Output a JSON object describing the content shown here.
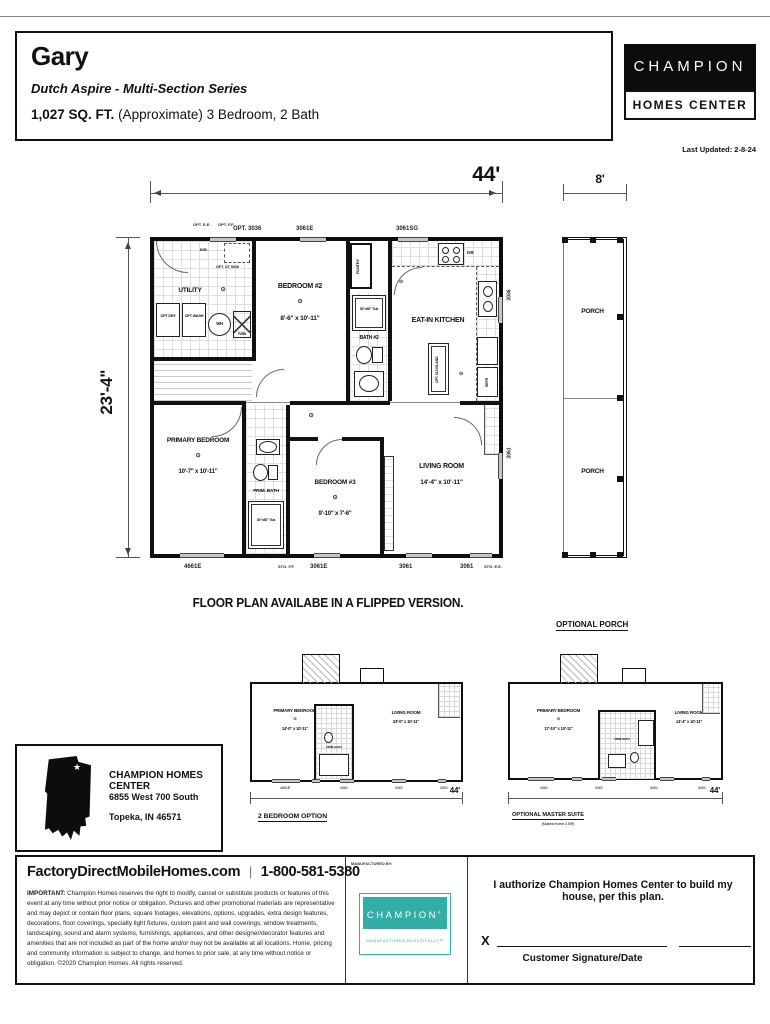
{
  "header": {
    "title": "Gary",
    "series": "Dutch Aspire - Multi-Section Series",
    "sqft": "1,027 SQ. FT.",
    "sqft_detail": "(Approximate) 3 Bedroom, 2 Bath",
    "last_updated": "Last Updated: 2-8-24"
  },
  "brand": {
    "champion": "CHAMPION",
    "homes_center": "HOMES CENTER",
    "teal": "#35ada7"
  },
  "icons": {
    "star": "★"
  },
  "plan": {
    "dim_width": "44'",
    "dim_depth": "23'-4\"",
    "dim_porch": "8'",
    "flipped_note": "FLOOR PLAN AVAILABE IN A FLIPPED VERSION.",
    "rooms": {
      "utility": "UTILITY",
      "bedroom2_name": "BEDROOM #2",
      "bedroom2_dims": "8'-6\" x 10'-11\"",
      "pantry": "PANTRY",
      "bath2": "BATH #2",
      "tub": "30\"x60\" Tub",
      "kitchen": "EAT-IN KITCHEN",
      "island": "OPT. 613 ISLAND",
      "primary_name": "PRIMARY BEDROOM",
      "primary_dims": "10'-7\" x 10'-11\"",
      "prim_bath": "PRIM. BATH",
      "bedroom3_name": "BEDROOM #3",
      "bedroom3_dims": "9'-10\" x 7'-6\"",
      "living_name": "LIVING ROOM",
      "living_dims": "14'-4\" x 10'-11\"",
      "porch": "PORCH"
    },
    "fixtures": {
      "wh": "WH",
      "furn": "FURN",
      "opt_dry": "OPT DRY",
      "opt_wash": "OPT WASH",
      "db": "DB",
      "refr": "REFR",
      "ut_sink": "OPT. UT SINK",
      "bb": "B/B",
      "light": "⊙"
    },
    "windows": {
      "top": [
        "OPT. E.E.",
        "OPT. F.F.",
        "OPT. 3036",
        "3061E",
        "3061SG"
      ],
      "bottom": [
        "4661E",
        "STG. F.F.",
        "3061E",
        "3061",
        "3061",
        "STG. E.E."
      ],
      "right": [
        "3036",
        "3061"
      ]
    }
  },
  "options": {
    "heading": "OPTIONAL PORCH",
    "plan_2br": {
      "caption": "2 BEDROOM OPTION",
      "primary_name": "PRIMARY BEDROOM",
      "primary_dims": "14'-0\" x 10'-11\"",
      "prim_bath": "PRIM. BATH",
      "living_name": "LIVING ROOM",
      "living_dims": "23'-0\" x 10'-11\"",
      "dim": "44'",
      "windows": [
        "4661E",
        "3061",
        "3061",
        "3061"
      ]
    },
    "plan_master": {
      "caption": "OPTIONAL MASTER SUITE",
      "subcaption": "(Makes Home 2 BR)",
      "primary_name": "PRIMARY BEDROOM",
      "primary_dims": "17'-10\" x 10'-11\"",
      "prim_bath": "PRIM. BATH",
      "living_name": "LIVING ROOM",
      "living_dims": "14'-4\" x 10'-11\"",
      "dim": "44'",
      "windows": [
        "3061",
        "3061",
        "3061",
        "3061"
      ]
    }
  },
  "dealer": {
    "name": "CHAMPION HOMES CENTER",
    "address1": "6855 West 700 South",
    "address2": "Topeka, IN 46571"
  },
  "footer": {
    "website": "FactoryDirectMobileHomes.com",
    "sep": "|",
    "phone": "1-800-581-5380",
    "important": "IMPORTANT:",
    "disclaimer": " Champion Homes reserves the right to modify, cancel or substitute products or features of this event at any time without prior notice or obligation. Pictures and other promotional materials are representative and may depict or contain floor plans, square footages, elevations, options, upgrades, extra design features, decorations, floor coverings, specialty light fixtures, custom paint and wall coverings, window treatments, landscaping, sound and alarm systems, furnishings, appliances, and other designer/decorator features and amenities that are not included as part of the home and/or may not be available at all locations. Home, pricing and community information is subject to change, and homes to prior sale, at any time without notice or obligation. ©2020 Champion Homes. All rights reserved.",
    "manufactured_by": "MANUFACTURED BY:",
    "logo_champion": "CHAMPION",
    "logo_reg": "®",
    "logo_tagline": "MANUFACTURED BEAUTIFULLY™",
    "authorize": "I authorize Champion Homes Center to build my house, per this plan.",
    "x": "X",
    "signature": "Customer Signature/Date"
  }
}
